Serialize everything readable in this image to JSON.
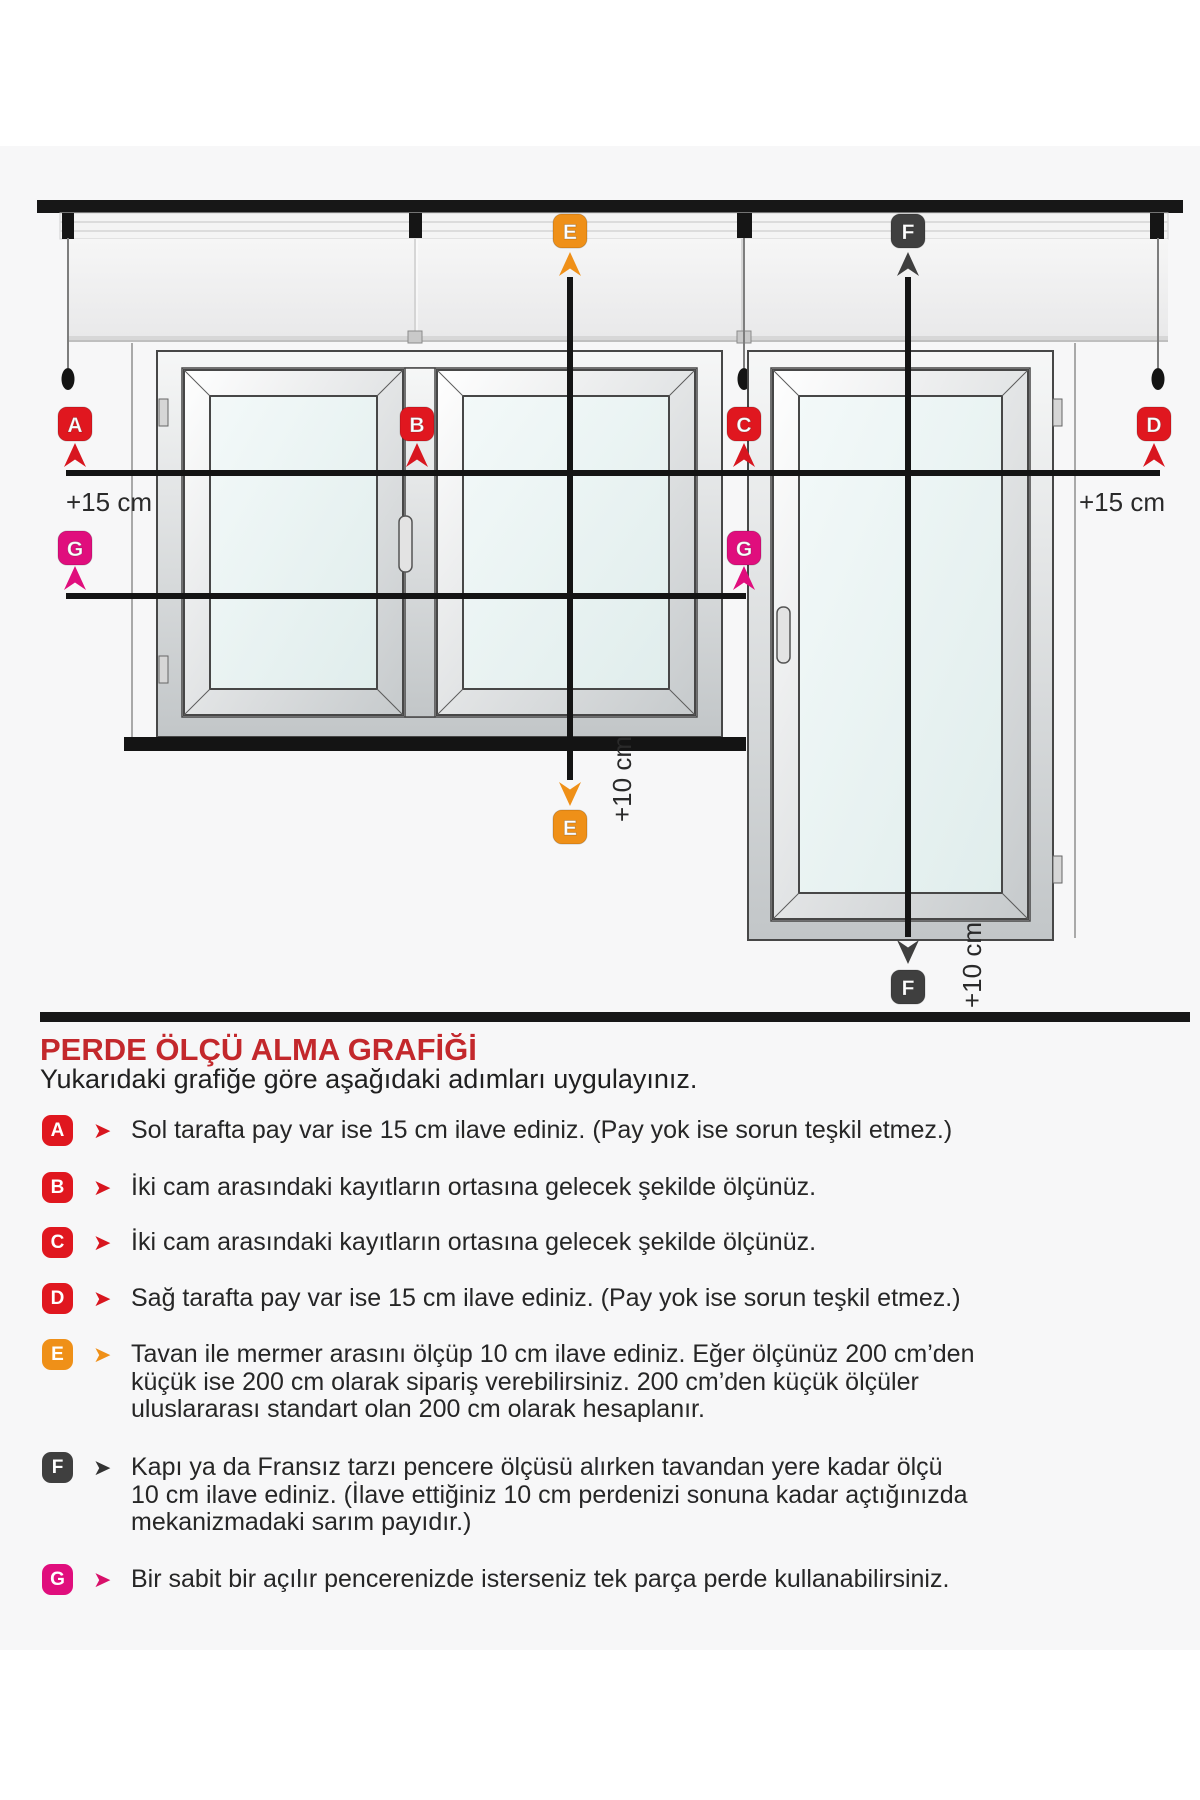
{
  "section": {
    "title": "PERDE ÖLÇÜ ALMA GRAFİĞİ",
    "subtitle": "Yukarıdaki grafiğe göre aşağıdaki adımları uygulayınız."
  },
  "diagram": {
    "badges": {
      "a": "A",
      "b": "B",
      "c": "C",
      "d": "D",
      "e": "E",
      "f": "F",
      "g": "G"
    },
    "labels": {
      "plus15_left": "+15 cm",
      "plus15_right": "+15 cm",
      "plus10_e": "+10 cm",
      "plus10_f": "+10 cm"
    },
    "colors": {
      "badge_red": "#e0171f",
      "badge_orange": "#ef9018",
      "badge_dark": "#3f3f3f",
      "badge_magenta": "#e00e7d",
      "title_red": "#c3282c",
      "line_black": "#141414"
    }
  },
  "steps": [
    {
      "key": "A",
      "text": "Sol tarafta pay var ise 15 cm ilave ediniz. (Pay yok ise sorun teşkil etmez.)"
    },
    {
      "key": "B",
      "text": "İki cam arasındaki kayıtların ortasına gelecek şekilde ölçünüz."
    },
    {
      "key": "C",
      "text": "İki cam arasındaki kayıtların ortasına gelecek şekilde ölçünüz."
    },
    {
      "key": "D",
      "text": "Sağ tarafta pay var ise 15 cm ilave ediniz. (Pay yok ise sorun teşkil etmez.)"
    },
    {
      "key": "E",
      "text": "Tavan ile mermer arasını ölçüp 10 cm ilave ediniz. Eğer ölçünüz 200 cm’den küçük ise 200 cm olarak sipariş verebilirsiniz. 200 cm’den küçük ölçüler uluslararası standart olan 200 cm olarak hesaplanır."
    },
    {
      "key": "F",
      "text": "Kapı ya da Fransız tarzı pencere ölçüsü alırken tavandan yere kadar ölçü 10 cm ilave ediniz. (İlave ettiğiniz 10 cm perdenizi sonuna kadar açtığınızda mekanizmadaki sarım payıdır.)"
    },
    {
      "key": "G",
      "text": "Bir sabit bir açılır pencerenizde isterseniz tek parça perde kullanabilirsiniz."
    }
  ],
  "step_chevron_icon": "➤"
}
